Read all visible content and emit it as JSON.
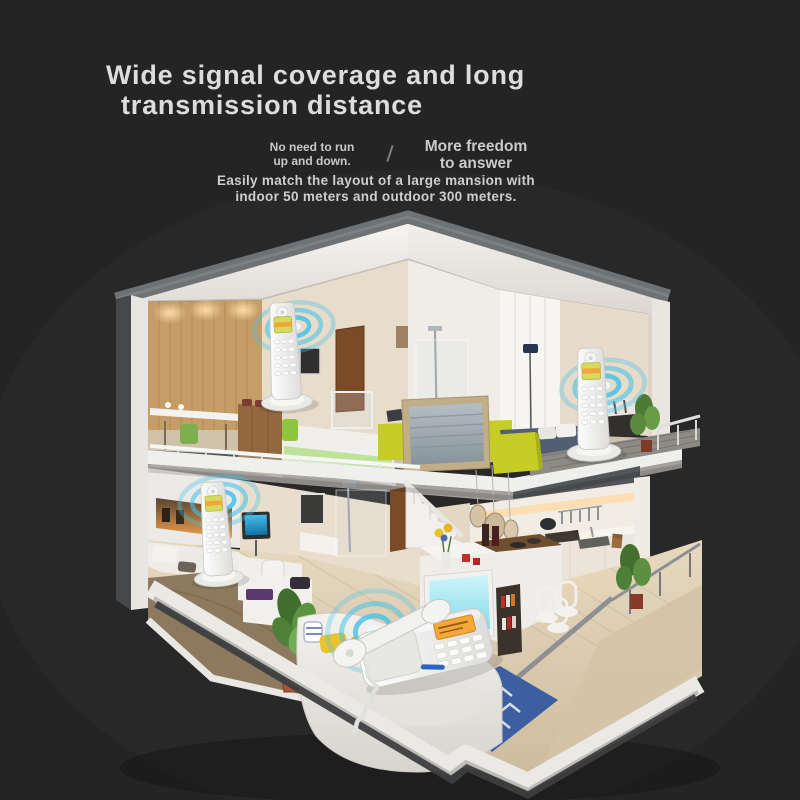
{
  "header": {
    "title_line1": "Wide signal coverage and long",
    "title_line2": "transmission distance",
    "note_left_line1": "No need to run",
    "note_left_line2": "up and down.",
    "divider": "/",
    "note_right_line1": "More freedom",
    "note_right_line2": "to answer",
    "subtitle_line1": "Easily match the layout of a large mansion with",
    "subtitle_line2": "indoor 50 meters and outdoor 300 meters."
  },
  "scene": {
    "illustration": "isometric-cutaway-duplex-home",
    "icons": [
      "signal-waves-icon",
      "cordless-handset-icon",
      "corded-phone-icon"
    ],
    "phone_placements": [
      "loft-cabinet",
      "upstairs-bedroom",
      "downstairs-bedroom",
      "living-room-sofa"
    ]
  },
  "colors": {
    "background": "#252425",
    "title": "#dedcdc",
    "subtext": "#c9c8c8",
    "signal_blue": "#45c2e8",
    "accent_yellow": "#c6cd25",
    "tv_cyan": "#a5e9f2",
    "rug_blue": "#3d5e9f",
    "wood_wall": "#c59d66",
    "house_white": "#f0eeec"
  }
}
